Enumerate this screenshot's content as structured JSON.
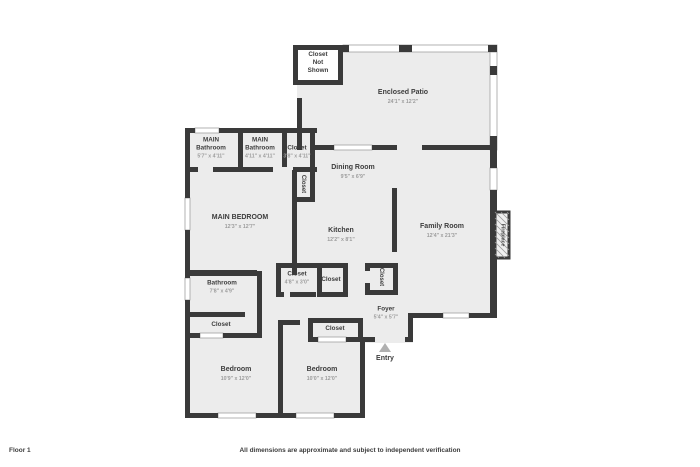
{
  "rooms": {
    "closet_not_shown": {
      "line1": "Closet",
      "line2": "Not",
      "line3": "Shown"
    },
    "enclosed_patio": {
      "name": "Enclosed Patio",
      "dims": "24'1\" x 12'2\""
    },
    "main_bathroom_1": {
      "line1": "MAIN",
      "line2": "Bathroom",
      "dims": "5'7\" x 4'11\""
    },
    "main_bathroom_2": {
      "line1": "MAIN",
      "line2": "Bathroom",
      "dims": "4'11\" x 4'11\""
    },
    "closet_top": {
      "name": "Closet",
      "dims": "3'8\" x 4'11\""
    },
    "dining_room": {
      "name": "Dining Room",
      "dims": "9'5\" x 6'9\""
    },
    "closet_vert_upper": {
      "name": "Closet"
    },
    "main_bedroom": {
      "name": "MAIN BEDROOM",
      "dims": "12'3\" x 12'7\""
    },
    "kitchen": {
      "name": "Kitchen",
      "dims": "12'2\" x 8'1\""
    },
    "family_room": {
      "name": "Family Room",
      "dims": "12'4\" x 21'3\""
    },
    "fireplace": {
      "name": "Fireplace"
    },
    "closet_mid_left": {
      "name": "Closet",
      "dims": "4'8\" x 3'0\""
    },
    "closet_mid_right": {
      "name": "Closet"
    },
    "closet_foyer": {
      "name": "Closet"
    },
    "bathroom": {
      "name": "Bathroom",
      "dims": "7'8\" x 4'9\""
    },
    "closet_bathroom": {
      "name": "Closet"
    },
    "foyer": {
      "name": "Foyer",
      "dims": "5'4\" x 5'7\""
    },
    "closet_hall": {
      "name": "Closet"
    },
    "entry": {
      "label": "Entry"
    },
    "bedroom_left": {
      "name": "Bedroom",
      "dims": "10'9\" x 12'0\""
    },
    "bedroom_right": {
      "name": "Bedroom",
      "dims": "10'0\" x 12'0\""
    }
  },
  "footer": {
    "floor_label": "Floor 1",
    "disclaimer": "All dimensions are approximate and subject to independent verification"
  },
  "colors": {
    "wall": "#3a3a3a",
    "floor": "#ececec",
    "label": "#3d3d3d",
    "dims": "#9c9c9c",
    "window": "#ffffff",
    "entry_arrow": "#b0b0b0",
    "background": "#ffffff"
  }
}
